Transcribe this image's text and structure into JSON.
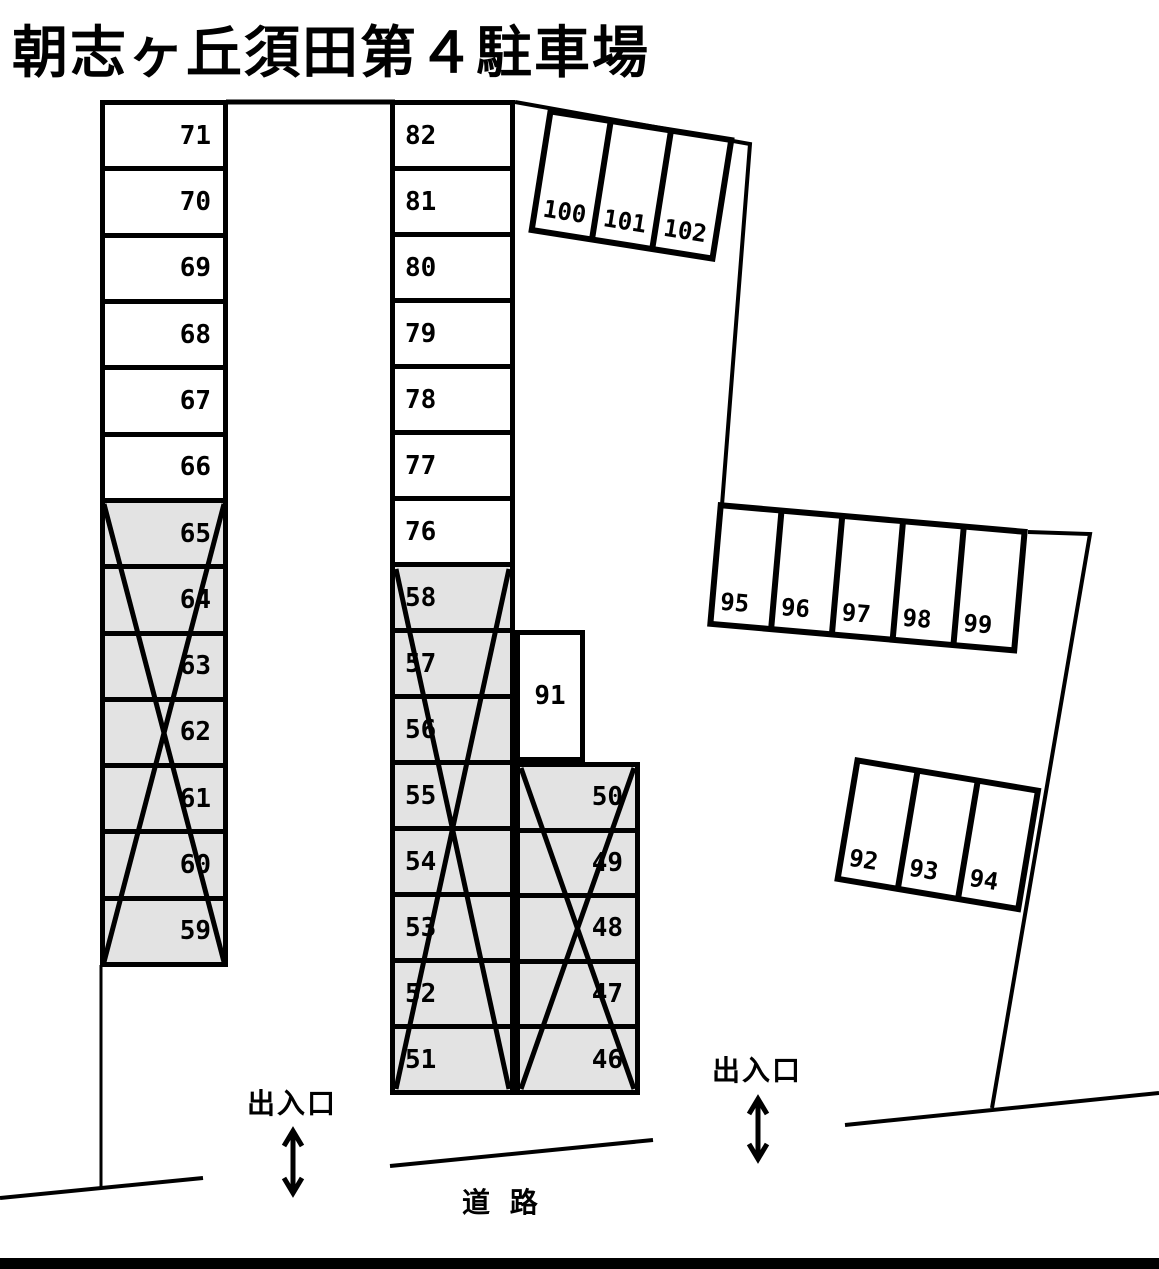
{
  "title": "朝志ヶ丘須田第４駐車場",
  "colors": {
    "line": "#000000",
    "open_fill": "#ffffff",
    "crossed_fill": "#e3e3e3"
  },
  "columns": {
    "colA": {
      "rows": [
        "71",
        "70",
        "69",
        "68",
        "67",
        "66",
        "65",
        "64",
        "63",
        "62",
        "61",
        "60",
        "59"
      ],
      "crossed": [
        "65",
        "64",
        "63",
        "62",
        "61",
        "60",
        "59"
      ]
    },
    "colB": {
      "rows": [
        "82",
        "81",
        "80",
        "79",
        "78",
        "77",
        "76",
        "58",
        "57",
        "56",
        "55",
        "54",
        "53",
        "52",
        "51"
      ],
      "crossed": [
        "58",
        "57",
        "56",
        "55",
        "54",
        "53",
        "52",
        "51"
      ]
    },
    "colC": {
      "rows": [
        "50",
        "49",
        "48",
        "47",
        "46"
      ],
      "crossed": [
        "50",
        "49",
        "48",
        "47",
        "46"
      ]
    }
  },
  "single_space": "91",
  "group_top_right": [
    "100",
    "101",
    "102"
  ],
  "group_right_mid": [
    "95",
    "96",
    "97",
    "98",
    "99"
  ],
  "group_right_low": [
    "92",
    "93",
    "94"
  ],
  "labels": {
    "entrance_left": "出入口",
    "entrance_right": "出入口",
    "road": "道 路"
  }
}
